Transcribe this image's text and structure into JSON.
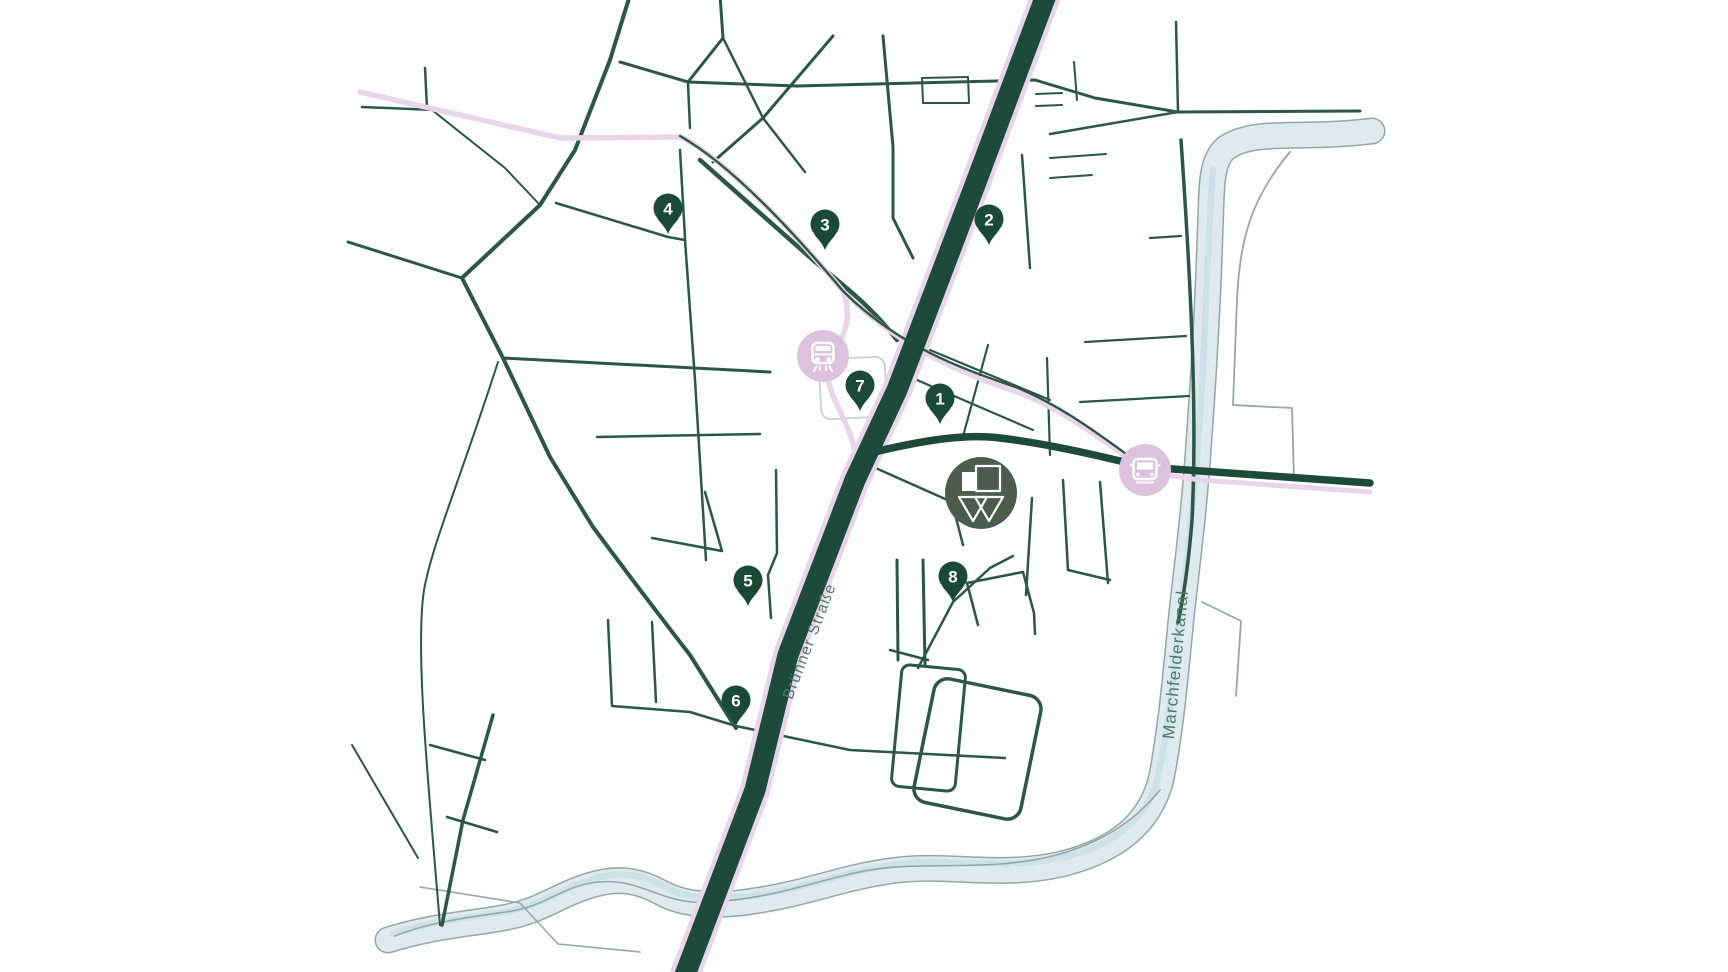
{
  "map": {
    "labels": {
      "main_street": "Brünner Straße",
      "canal": "Marchfelderkanal"
    },
    "pins": [
      {
        "number": "1",
        "x": 940,
        "y": 424
      },
      {
        "number": "2",
        "x": 989,
        "y": 245
      },
      {
        "number": "3",
        "x": 825,
        "y": 250
      },
      {
        "number": "4",
        "x": 668,
        "y": 234
      },
      {
        "number": "5",
        "x": 748,
        "y": 606
      },
      {
        "number": "6",
        "x": 736,
        "y": 726
      },
      {
        "number": "7",
        "x": 860,
        "y": 411
      },
      {
        "number": "8",
        "x": 953,
        "y": 602
      }
    ],
    "stations": [
      {
        "kind": "tram",
        "x": 823,
        "y": 356
      },
      {
        "kind": "bus",
        "x": 1145,
        "y": 470
      }
    ],
    "project_marker": {
      "x": 981,
      "y": 493
    },
    "colors": {
      "background": "#fdfefe",
      "road_main": "#1d4a39",
      "road_minor": "#2d5646",
      "road_faint": "#c7d1d2",
      "tram_pink": "#e8d5e9",
      "station_fill": "#dcc2dd",
      "station_glyph": "#ffffff",
      "canal_fill": "#dfeaee",
      "canal_stripe": "#cde1e6",
      "canal_outline": "#97a7a3",
      "pin_fill": "#1a4a36",
      "pin_number": "#ffffff",
      "logo_fill": "#4c5c4d",
      "logo_glyph": "#ffffff",
      "label_text": "#4d7a68"
    }
  }
}
